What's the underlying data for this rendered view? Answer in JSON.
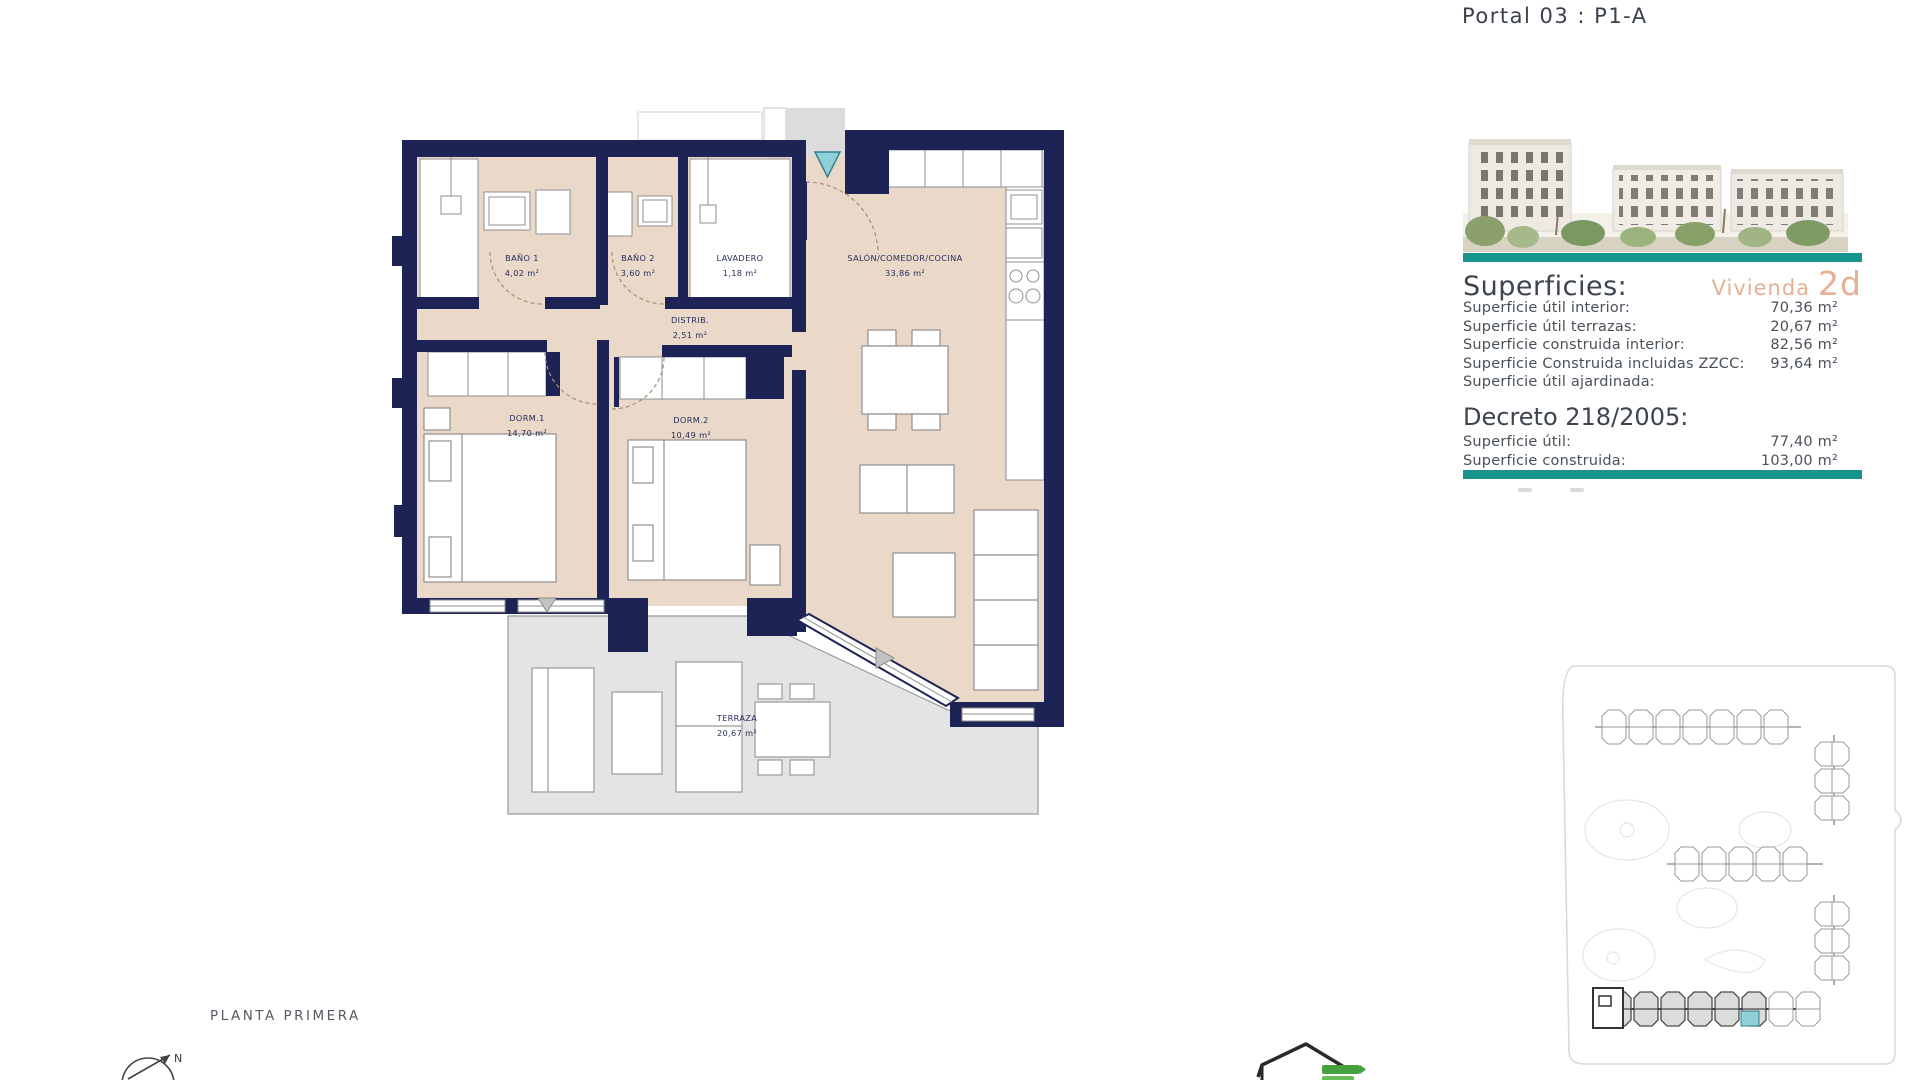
{
  "header": {
    "title": "Portal 03 : P1-A"
  },
  "panel": {
    "superficies_heading": "Superficies:",
    "vivienda_label": "Vivienda",
    "vivienda_value": "2d",
    "rows": [
      {
        "label": "Superficie útil interior:",
        "value": "70,36 m²"
      },
      {
        "label": "Superficie útil terrazas:",
        "value": "20,67 m²"
      },
      {
        "label": "Superficie construida interior:",
        "value": "82,56 m²"
      },
      {
        "label": "Superficie Construida incluidas ZZCC:",
        "value": "93,64 m²"
      },
      {
        "label": "Superficie útil ajardinada:",
        "value": ""
      }
    ],
    "decreto_heading": "Decreto 218/2005:",
    "decreto_rows": [
      {
        "label": "Superficie útil:",
        "value": "77,40 m²"
      },
      {
        "label": "Superficie construida:",
        "value": "103,00 m²"
      }
    ]
  },
  "plan": {
    "rooms": [
      {
        "name": "BAÑO 1",
        "area": "4,02 m²"
      },
      {
        "name": "BAÑO 2",
        "area": "3,60 m²"
      },
      {
        "name": "LAVADERO",
        "area": "1,18 m²"
      },
      {
        "name": "SALÓN/COMEDOR/COCINA",
        "area": "33,86 m²"
      },
      {
        "name": "DISTRIB.",
        "area": "2,51 m²"
      },
      {
        "name": "DORM.1",
        "area": "14,70 m²"
      },
      {
        "name": "DORM.2",
        "area": "10,49 m²"
      },
      {
        "name": "TERRAZA",
        "area": "20,67 m²"
      }
    ]
  },
  "footer": {
    "floor_label": "PLANTA PRIMERA",
    "compass_north": "N"
  },
  "colors": {
    "wall_navy": "#1e2355",
    "floor_beige": "#ead9c8",
    "terrace_gray": "#e4e4e4",
    "accent_teal": "#17948e",
    "vivienda_tan": "#e5b094",
    "highlight_unit": "#8fd0d8"
  }
}
